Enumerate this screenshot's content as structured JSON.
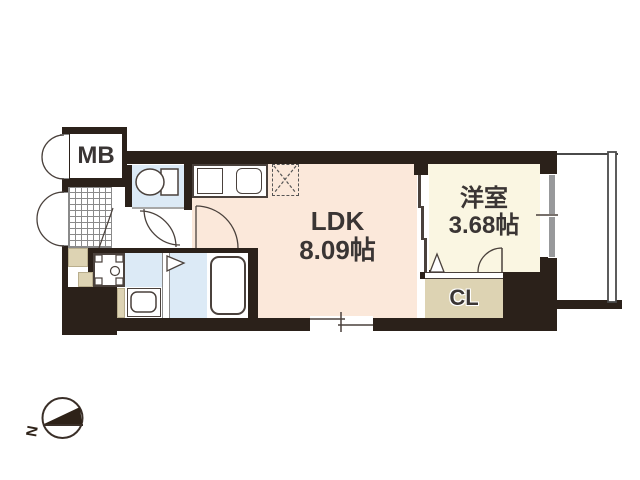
{
  "plan": {
    "type": "apartment-floor-plan",
    "rooms": [
      {
        "id": "ldk",
        "name": "LDK",
        "area": "8.09帖"
      },
      {
        "id": "western_room",
        "name": "洋室",
        "area": "3.68帖"
      },
      {
        "id": "closet",
        "name": "CL"
      },
      {
        "id": "meter_box",
        "name": "MB"
      }
    ],
    "compass": {
      "north_label": "N",
      "north_direction": "left"
    },
    "fixtures": {
      "toilet": "toilet-icon",
      "stove": "two-burner-stove-icon",
      "kitchen_sink": "kitchen-sink-icon",
      "refrigerator_space": "refrigerator-space-dashed-box",
      "bathtub": "bathtub-icon",
      "washing_machine_pan": "washing-machine-pan-icon",
      "vanity_basin": "vanity-basin-icon",
      "entrance_tile": "entrance-tile-hatch",
      "sliding_partition": "three-panel-sliding-door",
      "balcony": "balcony",
      "windows": "sliding-window",
      "doors": "swing-and-folding-doors"
    },
    "colors": {
      "wall": "#2b211a",
      "ldk_floor": "#fbe8da",
      "western_room_floor": "#faf6e2",
      "wet_area_floor": "#dceaf6",
      "closet_floor": "#ddd3b3",
      "window_frame": "#98999b",
      "line": "#4a413c",
      "text": "#3a3534"
    }
  }
}
